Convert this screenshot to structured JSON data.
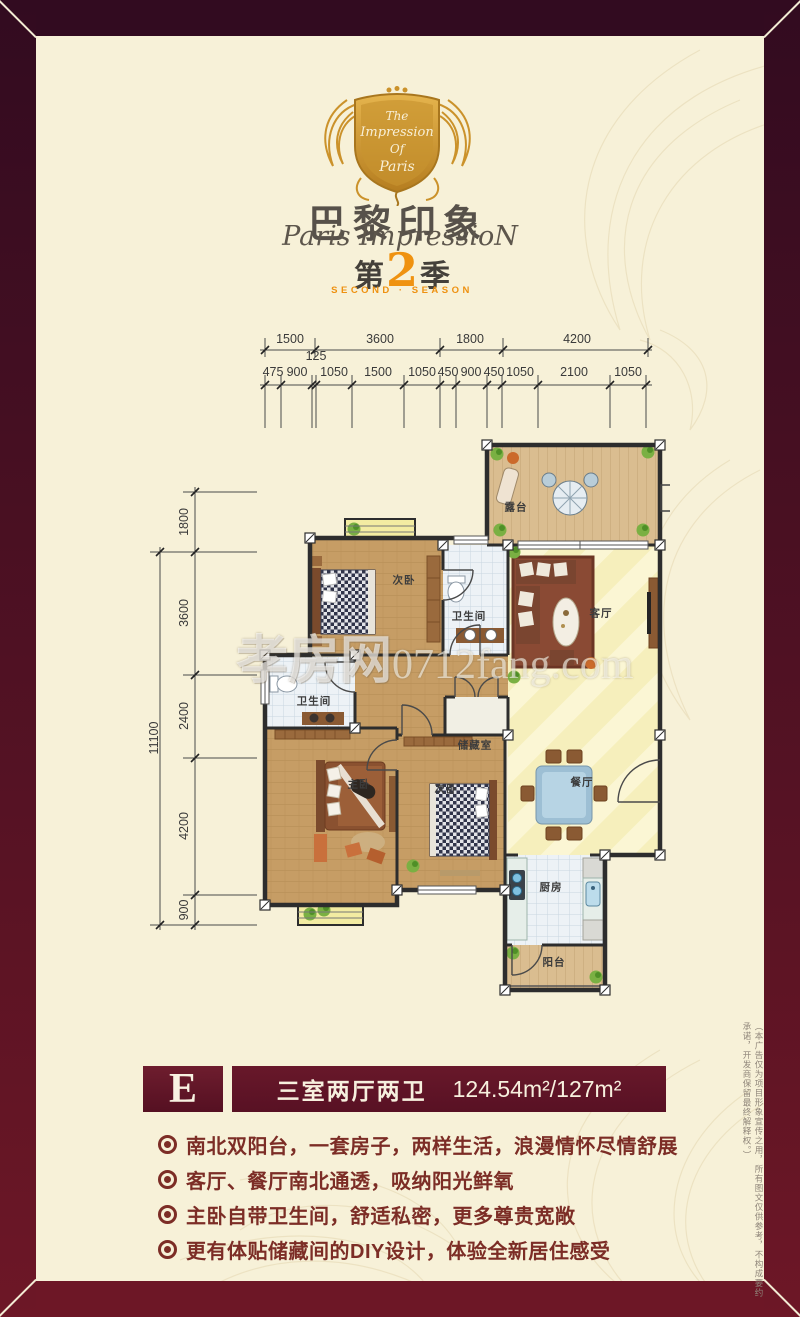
{
  "brand": {
    "crest": {
      "line1": "The",
      "line2": "Impression",
      "line3": "Of",
      "line4": "Paris"
    },
    "title_cn": "巴黎印象",
    "title_en": "Paris ImpressioN",
    "season_prefix": "第",
    "season_number": "2",
    "season_suffix": "季",
    "season_en": "SECOND · SEASON"
  },
  "watermark": {
    "cn": "孝房网",
    "en": "0712fang.com"
  },
  "dimensions": {
    "top_row1": [
      "1500",
      "3600",
      "1800",
      "4200"
    ],
    "top_row2": [
      "475",
      "900",
      "125",
      "1050",
      "1500",
      "1050",
      "450",
      "900",
      "450",
      "1050",
      "2100",
      "1050"
    ],
    "left_col": [
      "1800",
      "3600",
      "2400",
      "4200",
      "900"
    ],
    "left_total": "11100"
  },
  "plan": {
    "rooms": [
      {
        "label": "露台"
      },
      {
        "label": "次卧"
      },
      {
        "label": "卫生间"
      },
      {
        "label": "客厅"
      },
      {
        "label": "卫生间"
      },
      {
        "label": "主卧"
      },
      {
        "label": "储藏室"
      },
      {
        "label": "次卧"
      },
      {
        "label": "餐厅"
      },
      {
        "label": "厨房"
      },
      {
        "label": "阳台"
      }
    ]
  },
  "unit": {
    "letter": "E",
    "layout": "三室两厅两卫",
    "area": "124.54m²/127m²"
  },
  "features": [
    "南北双阳台，一套房子，两样生活，浪漫情怀尽情舒展",
    "客厅、餐厅南北通透，吸纳阳光鲜氧",
    "主卧自带卫生间，舒适私密，更多尊贵宽敞",
    "更有体贴储藏间的DIY设计，体验全新居住感受"
  ],
  "disclaimer": "（本广告仅为项目形象宣传之用，所有图文仅供参考，不构成要约承诺，开发商保留最终解释权。）",
  "colors": {
    "frame_dark": "#320b20",
    "frame_light": "#6d1726",
    "bar_maroon": "#5e1425",
    "gold": "#d49a2e",
    "orange": "#ef9210",
    "cream": "#f7f1d8",
    "feature_text": "#7c2d26"
  }
}
